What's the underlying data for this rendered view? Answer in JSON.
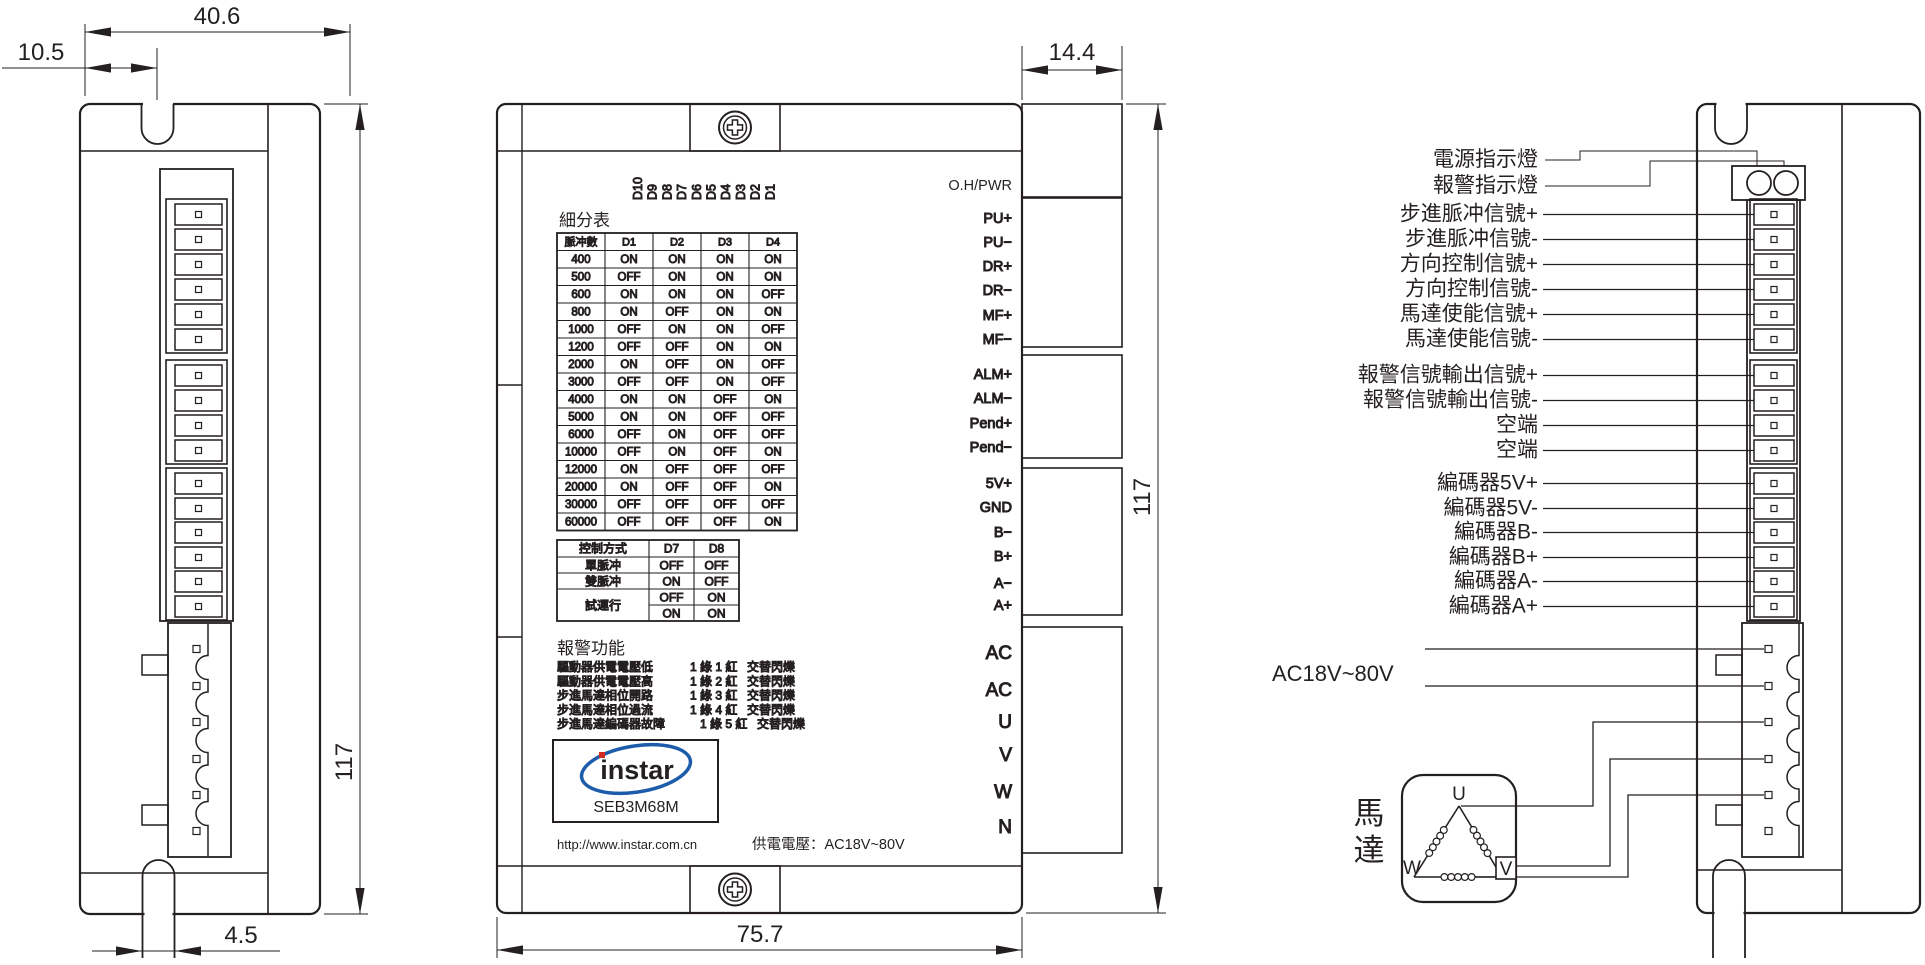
{
  "drawing": {
    "dimensions": {
      "left_width": "40.6",
      "left_offset": "10.5",
      "left_height": "117",
      "left_slot": "4.5",
      "front_width": "75.7",
      "front_connector_depth": "14.4",
      "front_height": "117"
    },
    "dip_labels": [
      "D10",
      "D9",
      "D8",
      "D7",
      "D6",
      "D5",
      "D4",
      "D3",
      "D2",
      "D1"
    ],
    "subdivision_table": {
      "title": "細分表",
      "headers": [
        "脈冲數",
        "D1",
        "D2",
        "D3",
        "D4"
      ],
      "rows": [
        [
          "400",
          "ON",
          "ON",
          "ON",
          "ON"
        ],
        [
          "500",
          "OFF",
          "ON",
          "ON",
          "ON"
        ],
        [
          "600",
          "ON",
          "ON",
          "ON",
          "OFF"
        ],
        [
          "800",
          "ON",
          "OFF",
          "ON",
          "ON"
        ],
        [
          "1000",
          "OFF",
          "ON",
          "ON",
          "OFF"
        ],
        [
          "1200",
          "OFF",
          "OFF",
          "ON",
          "ON"
        ],
        [
          "2000",
          "ON",
          "OFF",
          "ON",
          "OFF"
        ],
        [
          "3000",
          "OFF",
          "OFF",
          "ON",
          "OFF"
        ],
        [
          "4000",
          "ON",
          "ON",
          "OFF",
          "ON"
        ],
        [
          "5000",
          "ON",
          "ON",
          "OFF",
          "OFF"
        ],
        [
          "6000",
          "OFF",
          "ON",
          "OFF",
          "OFF"
        ],
        [
          "10000",
          "OFF",
          "ON",
          "OFF",
          "ON"
        ],
        [
          "12000",
          "ON",
          "OFF",
          "OFF",
          "OFF"
        ],
        [
          "20000",
          "ON",
          "OFF",
          "OFF",
          "ON"
        ],
        [
          "30000",
          "OFF",
          "OFF",
          "OFF",
          "OFF"
        ],
        [
          "60000",
          "OFF",
          "OFF",
          "OFF",
          "ON"
        ]
      ]
    },
    "control_table": {
      "headers": [
        "控制方式",
        "D7",
        "D8"
      ],
      "rows": [
        {
          "label": "單脈冲",
          "d7": "OFF",
          "d8": "OFF"
        },
        {
          "label": "雙脈冲",
          "d7": "ON",
          "d8": "OFF"
        },
        {
          "label": "試運行",
          "d7": "OFF",
          "d8": "ON"
        },
        {
          "label": "",
          "d7": "ON",
          "d8": "ON"
        }
      ]
    },
    "alarm": {
      "title": "報警功能",
      "items": [
        {
          "fault": "驅動器供電電壓低",
          "code": "1 綠 1 紅",
          "mode": "交替閃爍"
        },
        {
          "fault": "驅動器供電電壓高",
          "code": "1 綠 2 紅",
          "mode": "交替閃爍"
        },
        {
          "fault": "步進馬達相位開路",
          "code": "1 綠 3 紅",
          "mode": "交替閃爍"
        },
        {
          "fault": "步進馬達相位過流",
          "code": "1 綠 4 紅",
          "mode": "交替閃爍"
        },
        {
          "fault": "步進馬達編碼器故障",
          "code": "1 綠 5 紅",
          "mode": "交替閃爍"
        }
      ]
    },
    "brand": {
      "logo": "instar",
      "model": "SEB3M68M",
      "url": "http://www.instar.com.cn",
      "power_note": "供電電壓：AC18V~80V",
      "logo_blue": "#1d5cab",
      "logo_red": "#d02a23"
    },
    "terminals": {
      "status": "O.H/PWR",
      "signal": [
        "PU+",
        "PU−",
        "DR+",
        "DR−",
        "MF+",
        "MF−"
      ],
      "alarm_out": [
        "ALM+",
        "ALM−",
        "Pend+",
        "Pend−"
      ],
      "encoder": [
        "5V+",
        "GND",
        "B−",
        "B+",
        "A−",
        "A+"
      ],
      "power": [
        "AC",
        "AC",
        "U",
        "V",
        "W",
        "N"
      ]
    },
    "wiring": {
      "indicator_labels": [
        "電源指示燈",
        "報警指示燈"
      ],
      "signal_labels": [
        "步進脈冲信號+",
        "步進脈冲信號-",
        "方向控制信號+",
        "方向控制信號-",
        "馬達使能信號+",
        "馬達使能信號-"
      ],
      "alarm_labels": [
        "報警信號輸出信號+",
        "報警信號輸出信號-",
        "空端",
        "空端"
      ],
      "encoder_labels": [
        "編碼器5V+",
        "編碼器5V-",
        "編碼器B-",
        "編碼器B+",
        "編碼器A-",
        "編碼器A+"
      ],
      "power_label": "AC18V~80V",
      "motor_label": "馬達",
      "motor_terminals": [
        "U",
        "V",
        "W"
      ]
    }
  }
}
